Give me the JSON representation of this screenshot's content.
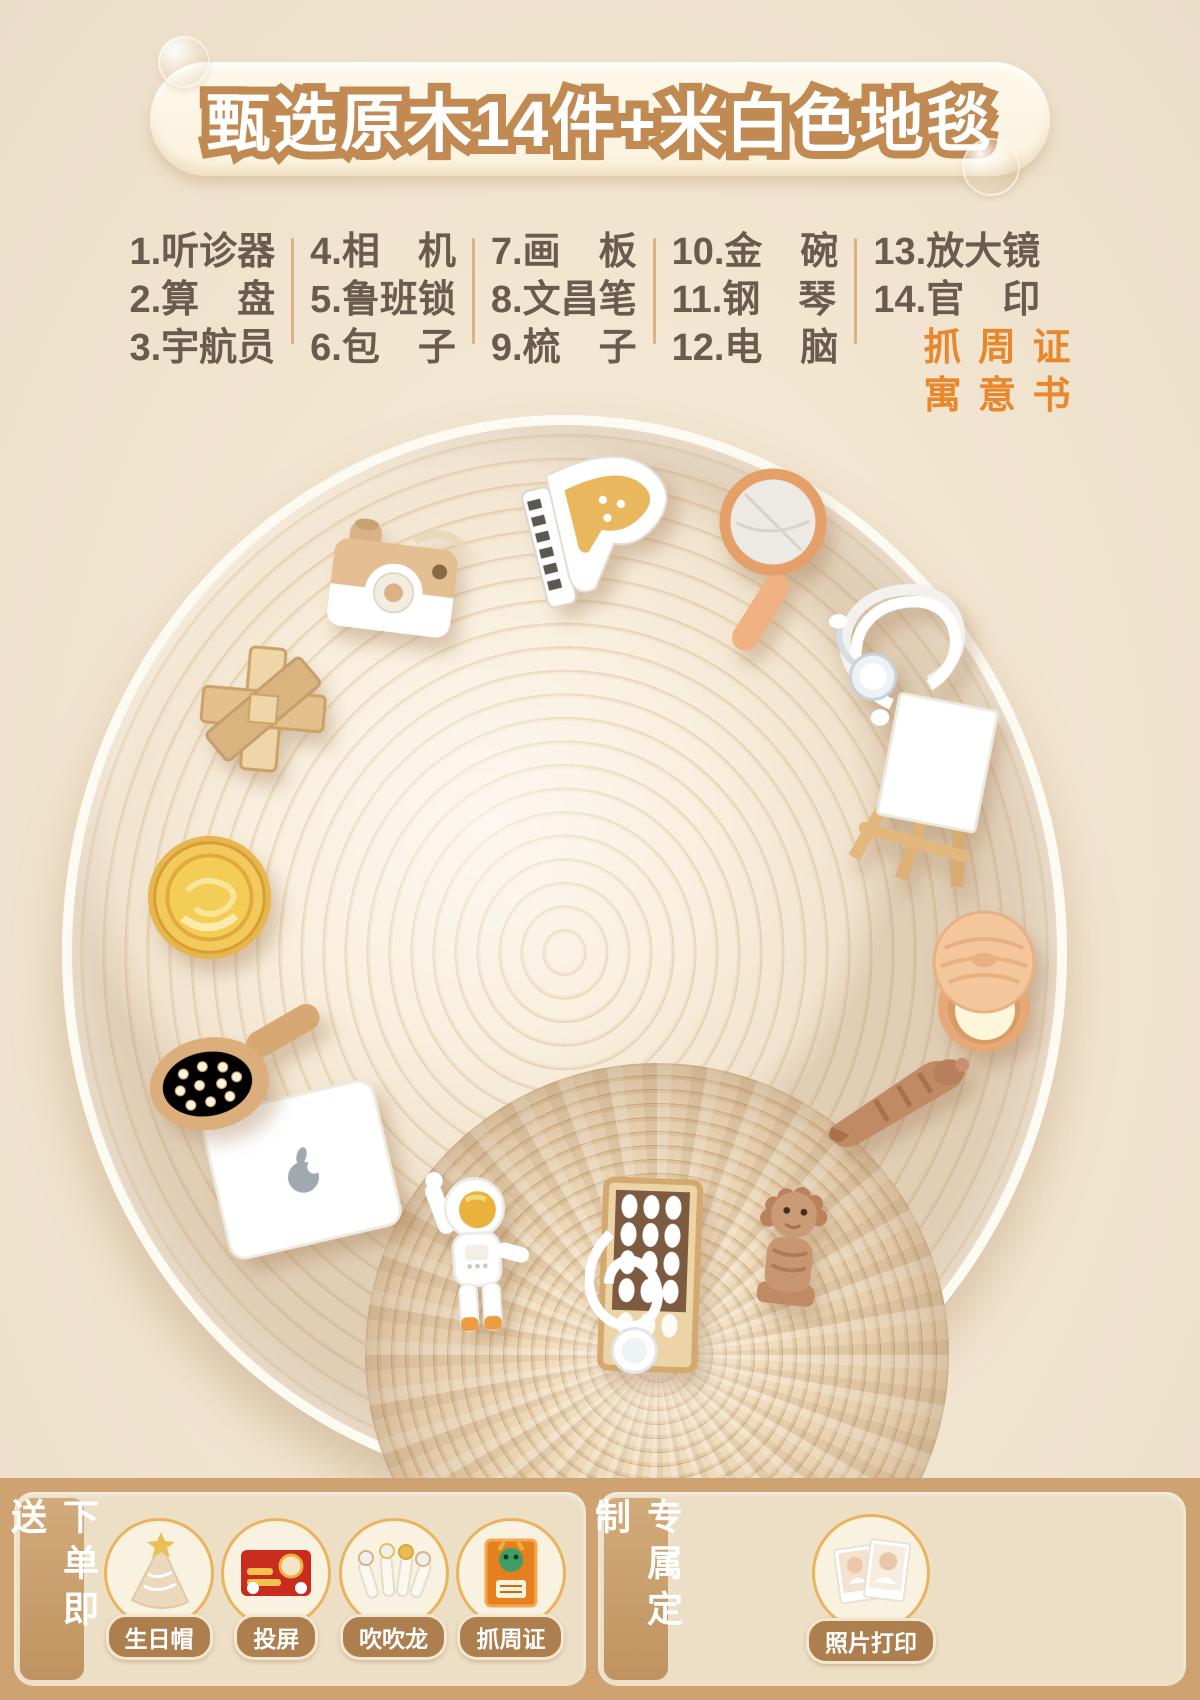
{
  "banner": {
    "title": "甄选原木14件+米白色地毯"
  },
  "item_list": {
    "columns": [
      {
        "rows": [
          "1.听诊器",
          "2.算　盘",
          "3.宇航员"
        ]
      },
      {
        "rows": [
          "4.相　机",
          "5.鲁班锁",
          "6.包　子"
        ]
      },
      {
        "rows": [
          "7.画　板",
          "8.文昌笔",
          "9.梳　子"
        ]
      },
      {
        "rows": [
          "10.金　碗",
          "11.钢　琴",
          "12.电　脑"
        ]
      },
      {
        "rows": [
          "13.放大镜",
          "14.官　印"
        ],
        "highlight_rows": [
          "抓 周 证",
          "寓 意 书"
        ]
      }
    ]
  },
  "carpet": {
    "items": [
      "wooden-camera",
      "toy-grand-piano",
      "magnifying-glass",
      "stethoscope",
      "easel",
      "steamer-bun",
      "wenchang-brush",
      "lion-seal",
      "abacus",
      "astronaut",
      "laptop",
      "hairbrush",
      "gold-bowl",
      "luban-lock"
    ]
  },
  "footer": {
    "left_panel": {
      "tab": "下单即送",
      "gifts": [
        {
          "label": "生日帽",
          "icon": "birthday-hat"
        },
        {
          "label": "投屏",
          "icon": "projection-card"
        },
        {
          "label": "吹吹龙",
          "icon": "party-blowers"
        },
        {
          "label": "抓周证",
          "icon": "zhuazhou-certificate"
        }
      ]
    },
    "right_panel": {
      "tab": "专属定制",
      "gifts": [
        {
          "label": "照片打印",
          "icon": "photo-prints"
        }
      ]
    }
  },
  "colors": {
    "accent_orange": "#e8872b",
    "title_stroke": "#c18a52",
    "list_text": "#6a5b4e",
    "footer_band": "#cfa271",
    "pill": "#ad7f4f",
    "circle_border": "#eab45f",
    "banner_bg": "#fdf6e7"
  }
}
